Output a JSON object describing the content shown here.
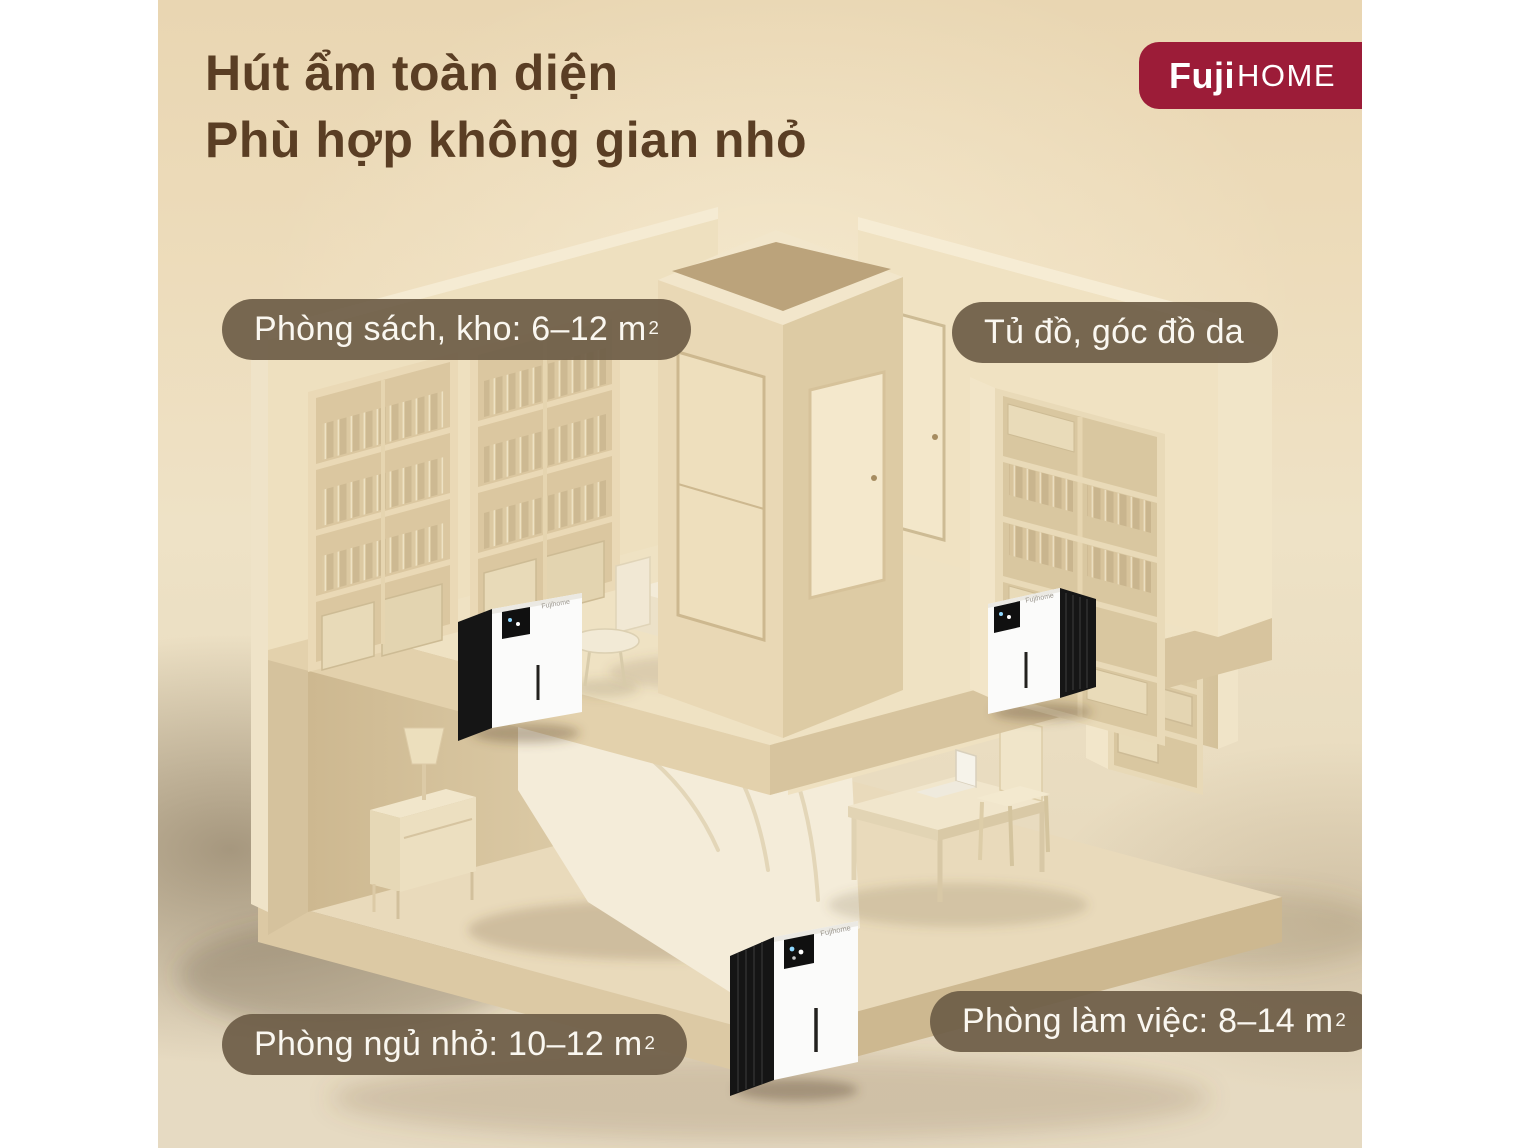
{
  "header": {
    "title_line1": "Hút ẩm toàn diện",
    "title_line2": "Phù hợp không gian nhỏ"
  },
  "logo": {
    "brand_bold": "Fuji",
    "brand_rest": "HOME"
  },
  "room_labels": {
    "library": {
      "text": "Phòng sách, kho: 6–12 m",
      "sup": "2"
    },
    "wardrobe": {
      "text": "Tủ đồ, góc đồ da",
      "sup": ""
    },
    "bedroom": {
      "text": "Phòng ngủ nhỏ: 10–12 m",
      "sup": "2"
    },
    "office": {
      "text": "Phòng làm việc: 8–14 m",
      "sup": "2"
    }
  },
  "device": {
    "brand_label": "Fujihome"
  },
  "colors": {
    "logo_bg": "#9c1c38",
    "title_text": "#5a3e24",
    "pill_bg": "rgba(108,92,70,0.92)",
    "pill_text": "#faf7f0",
    "backdrop_top": "#e9d6b2",
    "backdrop_bottom": "#e6dac2",
    "wall_light": "#f2e6cb",
    "wall_mid": "#e6d6b4",
    "floor": "#e9dabb",
    "device_body": "#fbfbfa",
    "device_panel": "#141414"
  }
}
